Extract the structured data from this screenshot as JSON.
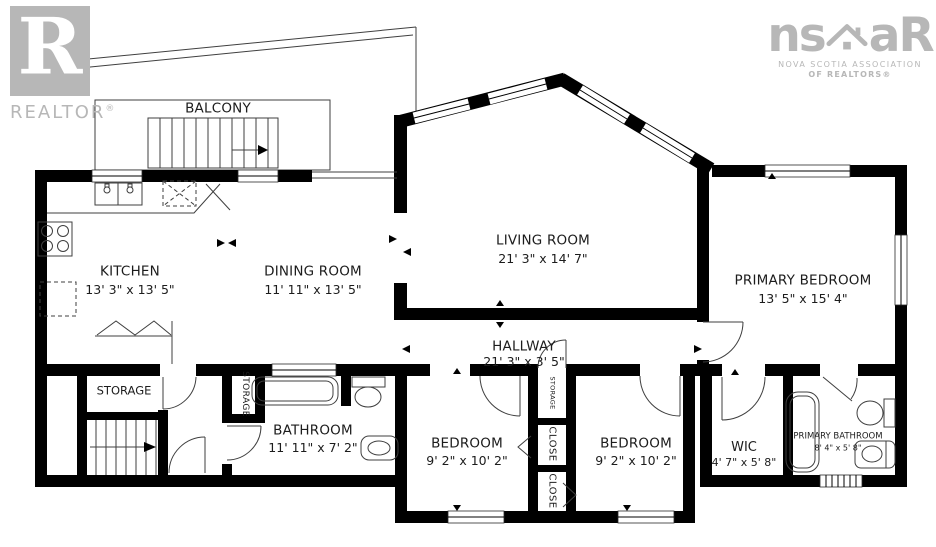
{
  "branding": {
    "realtor_logo": {
      "letter": "R",
      "word": "REALTOR",
      "registered": "®"
    },
    "nsar_logo": {
      "prefix": "ns",
      "suffix": "aR",
      "line1": "NOVA SCOTIA ASSOCIATION",
      "line2": "OF REALTORS®"
    }
  },
  "rooms": {
    "balcony": {
      "name": "BALCONY"
    },
    "kitchen": {
      "name": "KITCHEN",
      "dims": "13' 3\" x 13' 5\""
    },
    "dining": {
      "name": "DINING ROOM",
      "dims": "11' 11\" x 13' 5\""
    },
    "living": {
      "name": "LIVING ROOM",
      "dims": "21' 3\" x 14' 7\""
    },
    "primary_bedroom": {
      "name": "PRIMARY BEDROOM",
      "dims": "13' 5\" x 15' 4\""
    },
    "hallway": {
      "name": "HALLWAY",
      "dims": "21' 3\" x 3' 5\""
    },
    "storage_room": {
      "name": "STORAGE"
    },
    "storage_closet": {
      "name": "STORAGE"
    },
    "hall_storage": {
      "name": "STORAGE"
    },
    "bathroom": {
      "name": "BATHROOM",
      "dims": "11' 11\" x 7' 2\""
    },
    "bedroom_left": {
      "name": "BEDROOM",
      "dims": "9' 2\" x 10' 2\""
    },
    "bedroom_right": {
      "name": "BEDROOM",
      "dims": "9' 2\" x 10' 2\""
    },
    "closet_upper": {
      "name": "CLOSE"
    },
    "closet_lower": {
      "name": "CLOSE"
    },
    "wic": {
      "name": "WIC",
      "dims": "4' 7\" x 5' 8\""
    },
    "primary_bathroom": {
      "name": "PRIMARY BATHROOM",
      "dims": "8' 4\" x 5' 8\""
    }
  },
  "fixtures": [
    "double-sink",
    "dishwasher",
    "stove",
    "island",
    "bifold-doors",
    "bathtub",
    "toilet",
    "vanity-sink",
    "primary-bathtub",
    "primary-toilet",
    "primary-sink",
    "stairs",
    "balcony-stairs"
  ],
  "colors": {
    "wall": "#000000",
    "thin_line": "#3f3f3f",
    "label": "#1c1c1c",
    "logo_gray": "#b7b7b7"
  }
}
